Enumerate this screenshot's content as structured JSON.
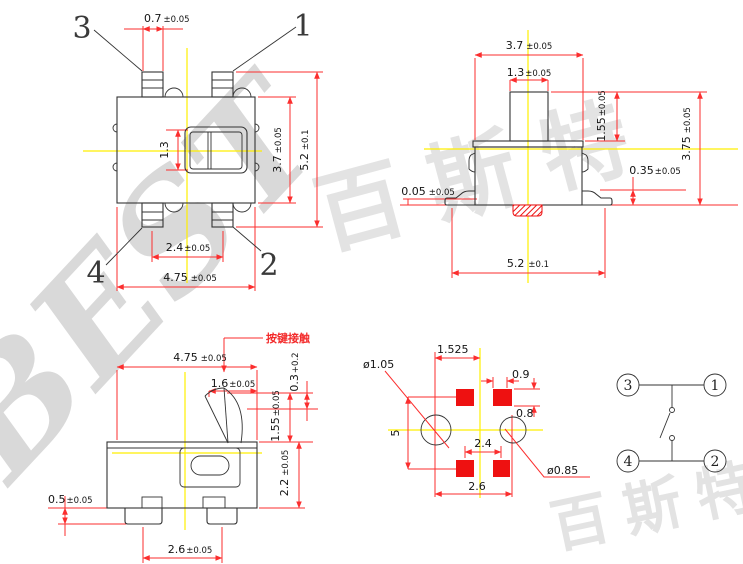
{
  "watermark": {
    "latin": "BEST",
    "cn": "百斯特"
  },
  "colors": {
    "dimension_line": "#fb2e2e",
    "outline": "#333333",
    "centerline": "#ffef00",
    "pad": "#ee1111",
    "annotation_red": "#f32b2b",
    "watermark_gray": "#d9d9d9"
  },
  "views": {
    "top": {
      "pins": {
        "p3": "3",
        "p1": "1",
        "p4": "4",
        "p2": "2"
      },
      "dims": {
        "pin_width": {
          "v": "0.7",
          "t": "±0.05"
        },
        "button": {
          "v": "1.3",
          "t": ""
        },
        "body_h": {
          "v": "3.7",
          "t": "±0.05"
        },
        "overall_h": {
          "v": "5.2",
          "t": "±0.1"
        },
        "pin_pitch": {
          "v": "2.4",
          "t": "±0.05"
        },
        "overall_w": {
          "v": "4.75",
          "t": "±0.05"
        }
      }
    },
    "front": {
      "dims": {
        "cap_w": {
          "v": "3.7",
          "t": "±0.05"
        },
        "plunger_w": {
          "v": "1.3",
          "t": "±0.05"
        },
        "plunger_h": {
          "v": "1.55",
          "t": "±0.05"
        },
        "total_h": {
          "v": "3.75",
          "t": "±0.05"
        },
        "lead_h": {
          "v": "0.35",
          "t": "±0.05"
        },
        "standoff": {
          "v": "0.05",
          "t": "±0.05"
        },
        "overall_w": {
          "v": "5.2",
          "t": "±0.1"
        }
      }
    },
    "side": {
      "annotation": "按键接触",
      "dims": {
        "overall_w": {
          "v": "4.75",
          "t": "±0.05"
        },
        "tip_w": {
          "v": "1.6",
          "t": "±0.05"
        },
        "travel": {
          "v": "0.3",
          "t": "+0.2"
        },
        "tip_h": {
          "v": "1.55",
          "t": "±0.05"
        },
        "body_h": {
          "v": "2.2",
          "t": "±0.05"
        },
        "pin_h": {
          "v": "0.5",
          "t": "±0.05"
        },
        "pin_pitch": {
          "v": "2.6",
          "t": "±0.05"
        }
      }
    },
    "footprint": {
      "dims": {
        "offset": {
          "v": "1.525",
          "t": ""
        },
        "hole_left": {
          "v": "ø1.05",
          "t": ""
        },
        "hole_right": {
          "v": "ø0.85",
          "t": ""
        },
        "pad_w": {
          "v": "0.9",
          "t": ""
        },
        "pad_h": {
          "v": "0.8",
          "t": ""
        },
        "row_pitch": {
          "v": "5",
          "t": ""
        },
        "pad_pitch": {
          "v": "2.4",
          "t": ""
        },
        "hole_pitch": {
          "v": "2.6",
          "t": ""
        }
      }
    },
    "schematic": {
      "pins": {
        "p3": "3",
        "p1": "1",
        "p4": "4",
        "p2": "2"
      }
    }
  }
}
